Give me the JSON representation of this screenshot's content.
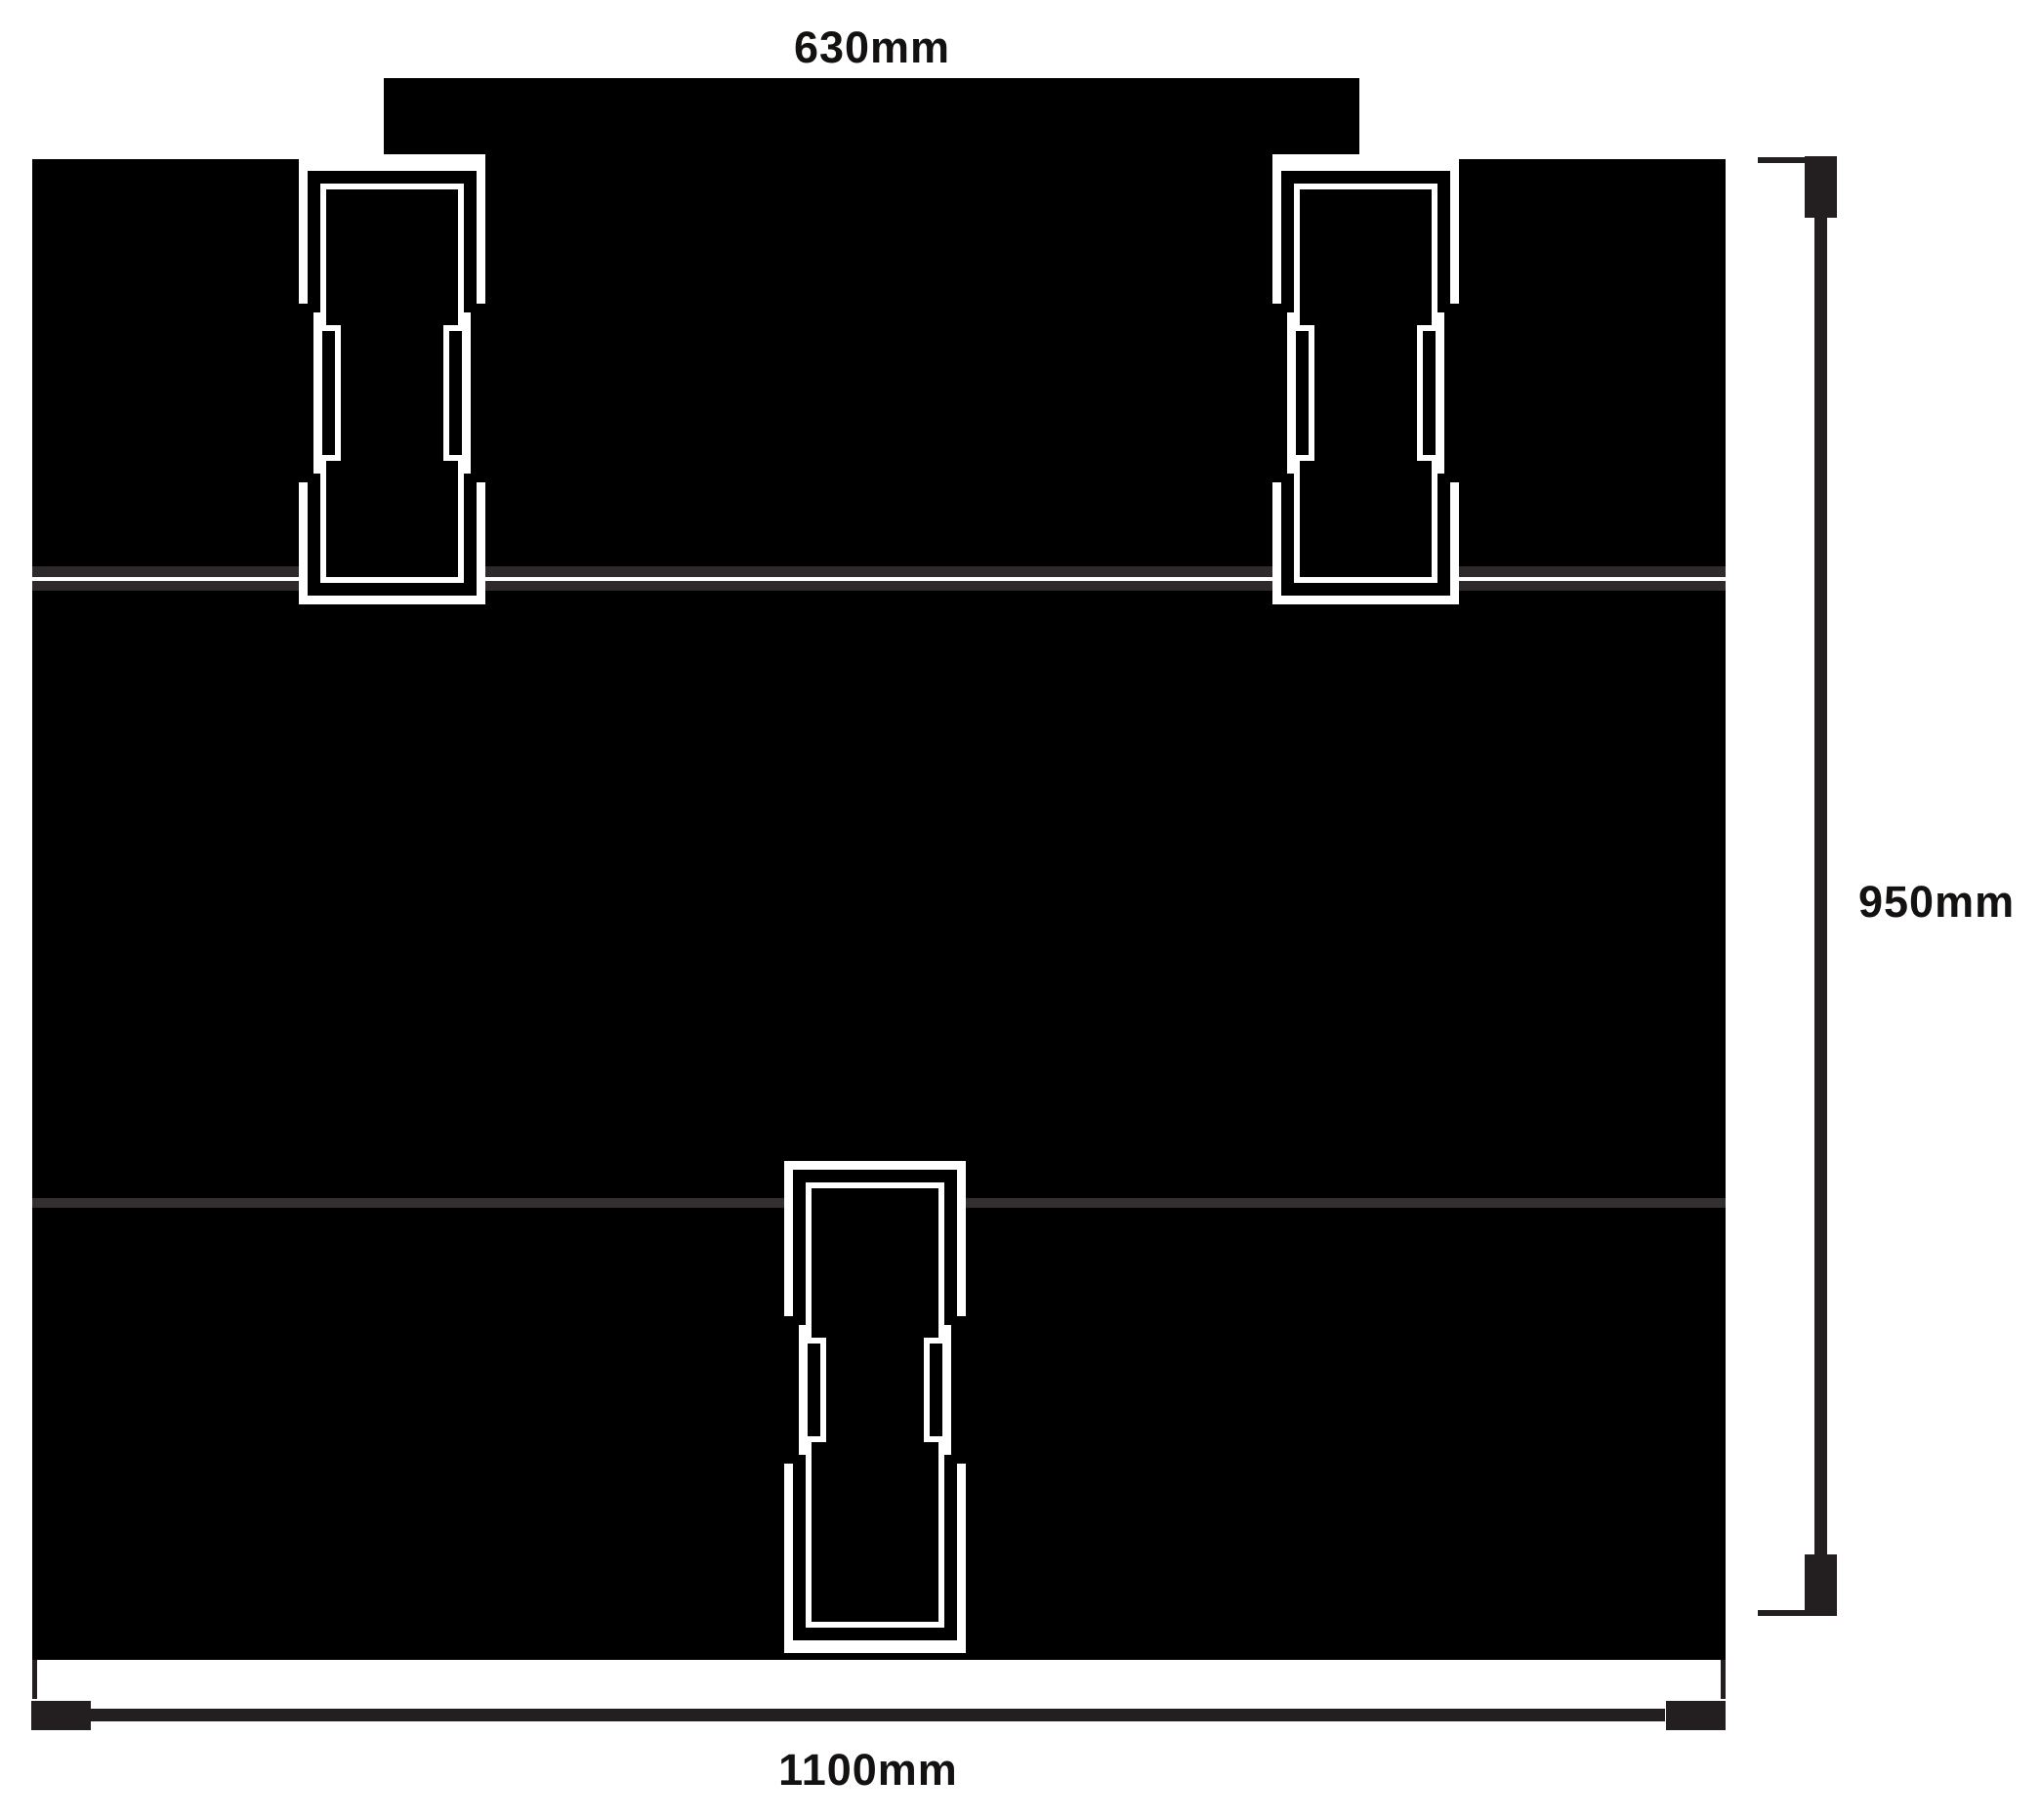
{
  "diagram": {
    "type": "product-dimension-drawing",
    "description": "Front elevation of a black cabinet/case with a top cap rail, three horizontal bands, two upper dog-bone latches, one lower centre dog-bone latch, a base rail, and overall dimension callouts",
    "colors": {
      "background": "#ffffff",
      "fill": "#000000",
      "ink": "#231f20",
      "seam_faint": "#2e292a",
      "label_text": "#141111"
    },
    "labels": {
      "top_width": "630mm",
      "side_height": "950mm",
      "bottom_width": "1100mm"
    },
    "parts": [
      "top-cap",
      "upper-band",
      "middle-band",
      "lower-band",
      "base-rail",
      "latch-left",
      "latch-right",
      "latch-bottom"
    ]
  }
}
